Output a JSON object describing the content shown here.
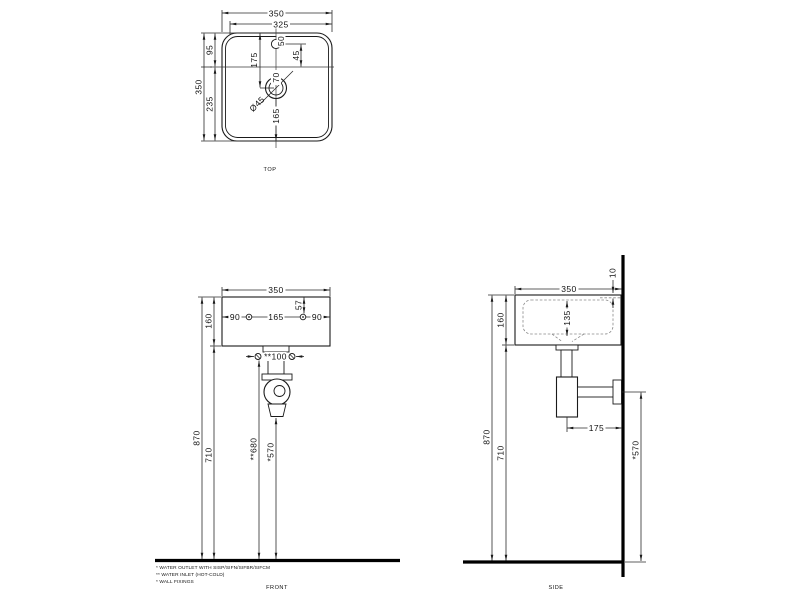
{
  "views": {
    "top": {
      "label": "TOP",
      "width_overall": "350",
      "width_inner": "325",
      "depth_overall": "350",
      "rim_to_centerline": "95",
      "centerline_to_front": "235",
      "back_to_drain": "175",
      "faucet_hole": "50",
      "faucet_to_centerline": "45",
      "centerline_to_drain": "70",
      "drain_diameter": "Ø45",
      "drain_to_front": "165"
    },
    "front": {
      "label": "FRONT",
      "width": "350",
      "basin_height": "160",
      "rim_to_fixing": "57",
      "edge_to_fixing_left": "90",
      "fixing_spacing": "165",
      "edge_to_fixing_right": "90",
      "inlet_spacing": "**100",
      "floor_to_rim": "870",
      "floor_to_basin_bottom": "710",
      "floor_to_inlet": "**680",
      "floor_to_outlet": "*570"
    },
    "side": {
      "label": "SIDE",
      "depth": "350",
      "rim_lip": "10",
      "basin_height": "160",
      "bowl_depth": "135",
      "floor_to_rim": "870",
      "floor_to_basin_bottom": "710",
      "trap_to_wall": "175",
      "floor_to_outlet": "*570"
    }
  },
  "notes": {
    "outlet": "* WATER OUTLET WITH SISP/SIFN/SIFBR/SIFCM",
    "inlet": "** WATER INLET  (HOT-COLD)",
    "fixings": "* WALL FIXINGS"
  }
}
